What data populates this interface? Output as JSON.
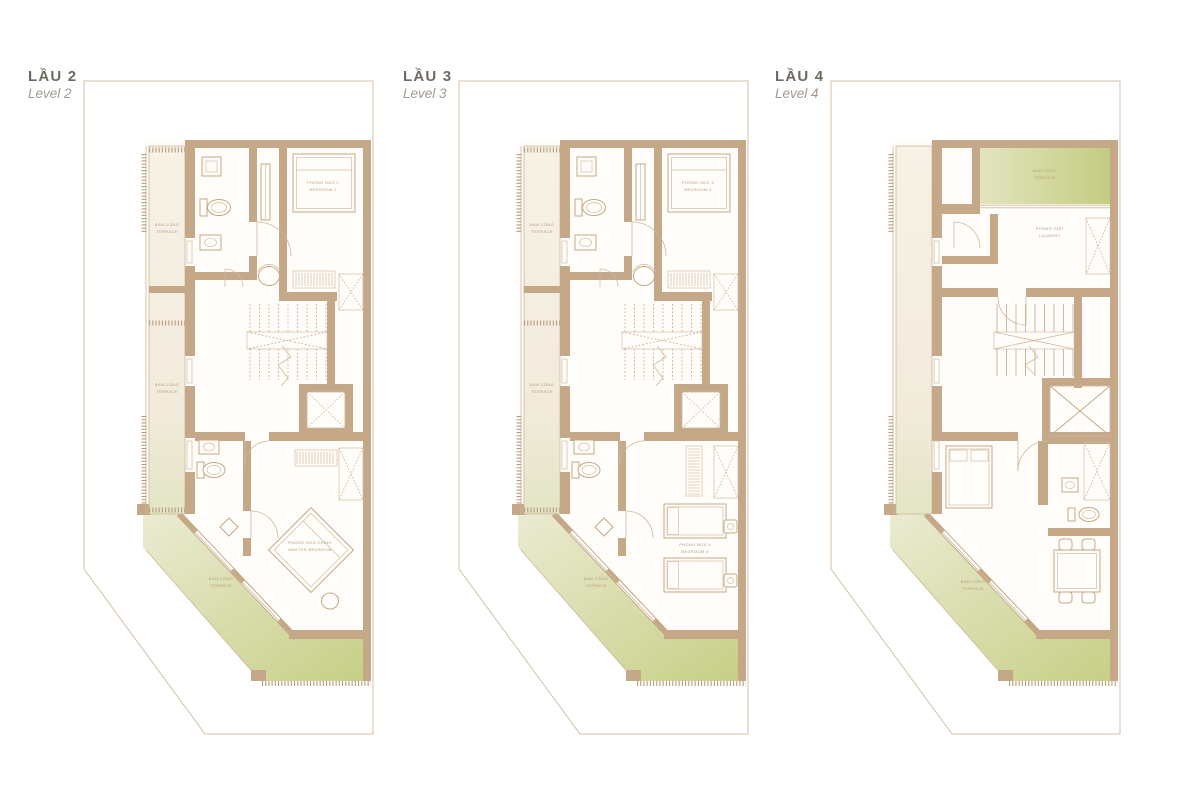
{
  "page": {
    "background": "#ffffff"
  },
  "colors": {
    "wall": "#c4a888",
    "floor": "#fffdf9",
    "lot_line": "#d4bfa6",
    "balcony_cream": "#f5efe2",
    "terrace_green": "#c6cf85",
    "terrace_green_light": "#ebebd2",
    "label_text": "#b59b7c",
    "title_text": "#6e6a62",
    "subtitle_text": "#a19a90"
  },
  "plans": [
    {
      "id": "level-2",
      "title": "LẦU 2",
      "subtitle": "Level 2",
      "labels": {
        "balcony_upper": {
          "vi": "BAN CÔNG",
          "en": "TERRACE"
        },
        "balcony_lower": {
          "vi": "BAN CÔNG",
          "en": "TERRACE"
        },
        "bedroom_top": {
          "vi": "PHÒNG NGỦ 2",
          "en": "BEDROOM 2"
        },
        "bedroom_bottom": {
          "vi": "PHÒNG NGỦ CHÍNH",
          "en": "MASTER BEDROOM"
        },
        "terrace_bottom": {
          "vi": "BAN CÔNG",
          "en": "TERRACE"
        }
      }
    },
    {
      "id": "level-3",
      "title": "LẦU 3",
      "subtitle": "Level 3",
      "labels": {
        "balcony_upper": {
          "vi": "BAN CÔNG",
          "en": "TERRACE"
        },
        "balcony_lower": {
          "vi": "BAN CÔNG",
          "en": "TERRACE"
        },
        "bedroom_top": {
          "vi": "PHÒNG NGỦ 3",
          "en": "BEDROOM 3"
        },
        "bedroom_bottom": {
          "vi": "PHÒNG NGỦ 4",
          "en": "BEDROOM 4"
        },
        "terrace_bottom": {
          "vi": "BAN CÔNG",
          "en": "TERRACE"
        }
      }
    },
    {
      "id": "level-4",
      "title": "LẦU 4",
      "subtitle": "Level 4",
      "labels": {
        "terrace_top": {
          "vi": "BAN CÔNG",
          "en": "TERRACE"
        },
        "utility_room": {
          "vi": "PHÒNG GIẶT",
          "en": "LAUNDRY"
        },
        "terrace_bottom": {
          "vi": "BAN CÔNG",
          "en": "TERRACE"
        }
      }
    }
  ]
}
